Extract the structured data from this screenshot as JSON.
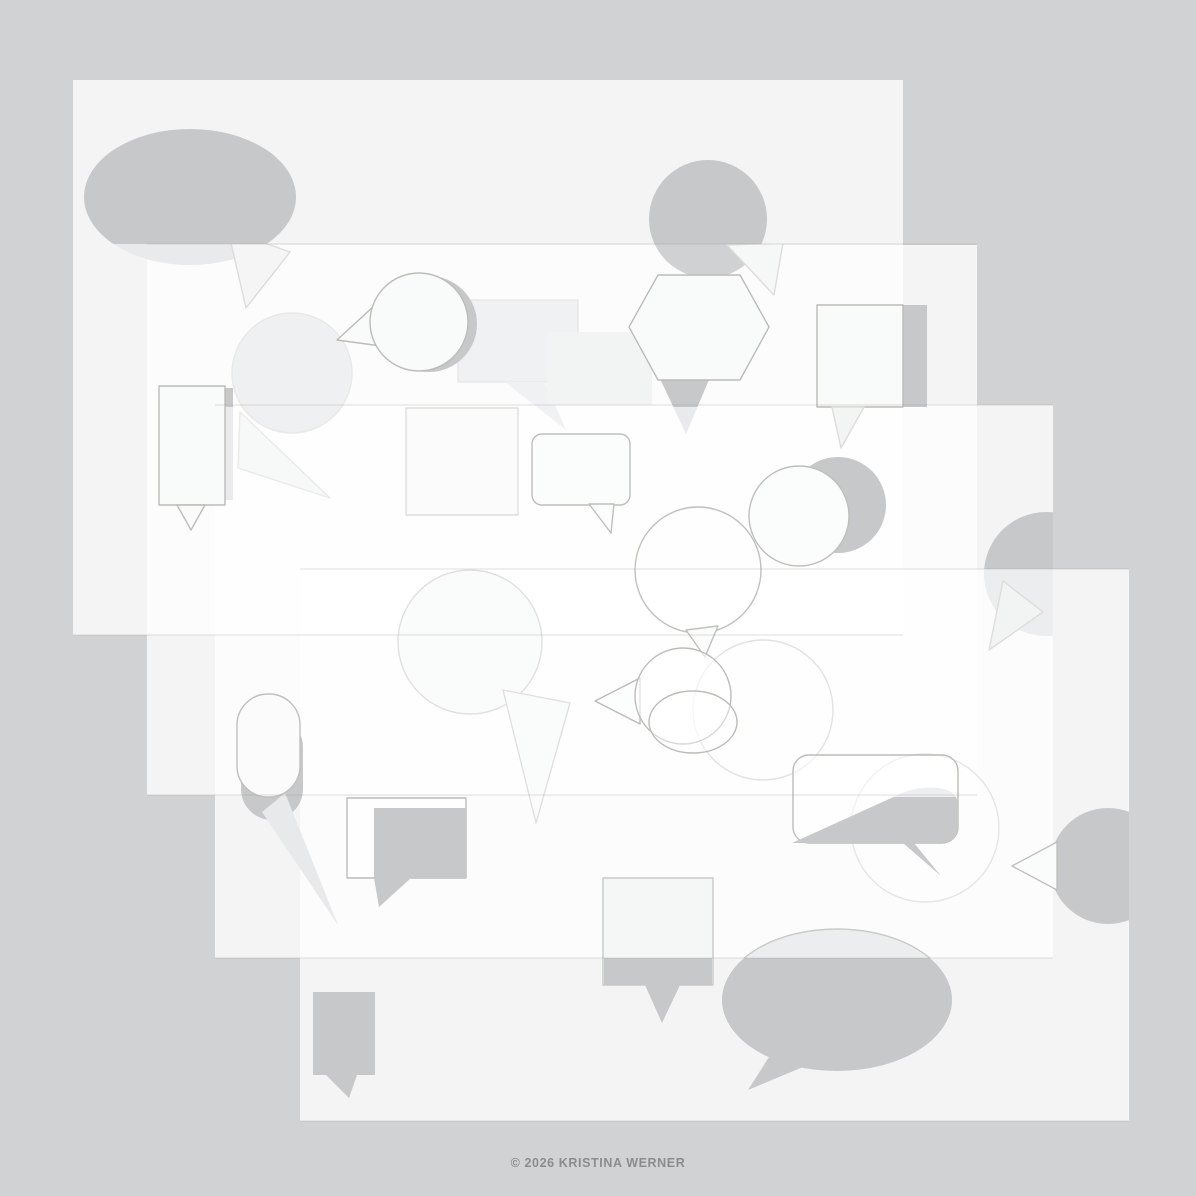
{
  "canvas": {
    "width": 1196,
    "height": 1196,
    "background": "#D1D2D4"
  },
  "footer": {
    "copyright": "© 2026 KRISTINA WERNER",
    "color": "#8A8C8E"
  },
  "palette": {
    "sheet_fill": "rgba(255,255,255,0.75)",
    "shape_solid": "#C6C8CA",
    "shape_faded": "#E9EAEB",
    "outline": "#BCBCB7",
    "seam": "rgba(150,150,142,0.30)"
  },
  "sheets": [
    {
      "name": "sheet-1",
      "x": 73,
      "y": 80,
      "w": 830,
      "h": 555
    },
    {
      "name": "sheet-2",
      "x": 147,
      "y": 245,
      "w": 830,
      "h": 550
    },
    {
      "name": "sheet-3",
      "x": 215,
      "y": 405,
      "w": 838,
      "h": 553
    },
    {
      "name": "sheet-4",
      "x": 300,
      "y": 569,
      "w": 829,
      "h": 552
    }
  ],
  "clips": {
    "s1a244": [
      73,
      80,
      830,
      164
    ],
    "s1b244": [
      73,
      244,
      830,
      391
    ],
    "a244": [
      0,
      0,
      1196,
      244
    ],
    "b244": [
      0,
      244,
      1196,
      952
    ],
    "a407": [
      0,
      0,
      1196,
      407
    ],
    "b407": [
      0,
      407,
      1196,
      789
    ],
    "s3a569": [
      215,
      405,
      838,
      164
    ],
    "s3b569": [
      215,
      569,
      838,
      389
    ],
    "a797": [
      0,
      0,
      1196,
      797
    ],
    "b797": [
      0,
      797,
      1196,
      399
    ],
    "s4": [
      300,
      569,
      829,
      552
    ],
    "a958": [
      0,
      0,
      1196,
      958
    ],
    "b958": [
      0,
      958,
      1196,
      238
    ]
  },
  "seams": [
    {
      "x1": 147,
      "y": 244,
      "x2": 977
    },
    {
      "x1": 215,
      "y": 405,
      "x2": 1053
    },
    {
      "x1": 300,
      "y": 569,
      "x2": 1129
    },
    {
      "x1": 73,
      "y": 635,
      "x2": 903
    },
    {
      "x1": 147,
      "y": 795,
      "x2": 977
    },
    {
      "x1": 215,
      "y": 958,
      "x2": 1053
    },
    {
      "x1": 300,
      "y": 1121,
      "x2": 1129
    }
  ],
  "shapes": [
    {
      "name": "speech-bubble-ellipse-solid",
      "kind": "ellipse",
      "cx": 190,
      "cy": 197,
      "rx": 106,
      "ry": 68,
      "fill": "#C6C8CA",
      "clip": "s1a244"
    },
    {
      "name": "speech-bubble-ellipse-solid-faded",
      "kind": "ellipse",
      "cx": 190,
      "cy": 197,
      "rx": 106,
      "ry": 68,
      "fill": "#E9EAEB",
      "clip": "s1b244"
    },
    {
      "name": "speech-bubble-ellipse-tail-outline",
      "kind": "polygon",
      "points": [
        [
          228,
          230
        ],
        [
          290,
          252
        ],
        [
          246,
          308
        ]
      ],
      "fill": "#F5F5F6",
      "stroke": "#DCDCD8",
      "clip": "b244"
    },
    {
      "name": "speech-bubble-circle-solid",
      "kind": "circle",
      "cx": 708,
      "cy": 219,
      "r": 59,
      "fill": "#C6C8CA",
      "clip": "a244"
    },
    {
      "name": "speech-bubble-circle-solid-faded",
      "kind": "circle",
      "cx": 708,
      "cy": 219,
      "r": 59,
      "fill": "#CFD1D3",
      "clip": "b244"
    },
    {
      "name": "speech-bubble-circle-tail-outline",
      "kind": "polygon",
      "points": [
        [
          727,
          245
        ],
        [
          783,
          243
        ],
        [
          774,
          295
        ]
      ],
      "fill": "#F6F7F7",
      "stroke": "#DDDDD9",
      "clip": "b244"
    },
    {
      "name": "speech-bubble-round-faint",
      "kind": "circle",
      "cx": 292,
      "cy": 373,
      "r": 60,
      "fill": "#EFF0F1",
      "stroke": "#E8E8E5"
    },
    {
      "name": "speech-bubble-round-faint-tail",
      "kind": "polygon",
      "points": [
        [
          240,
          412
        ],
        [
          330,
          498
        ],
        [
          238,
          468
        ]
      ],
      "fill": "#F7F8F8",
      "stroke": "#EAEAE7"
    },
    {
      "name": "speech-bubble-rect-faint",
      "kind": "rect",
      "x": 458,
      "y": 300,
      "w": 120,
      "h": 82,
      "fill": "#F0F1F2",
      "stroke": "#E8E8E5"
    },
    {
      "name": "speech-bubble-rect-faint-tail",
      "kind": "polygon",
      "points": [
        [
          505,
          382
        ],
        [
          545,
          382
        ],
        [
          566,
          430
        ]
      ],
      "fill": "#F0F1F2"
    },
    {
      "name": "speech-bubble-square-faint",
      "kind": "rect",
      "x": 547,
      "y": 332,
      "w": 105,
      "h": 73,
      "fill": "#F2F3F3"
    },
    {
      "name": "speech-bubble-drop-solid-offset",
      "kind": "circle",
      "cx": 429,
      "cy": 324,
      "r": 48,
      "fill": "#C6C8CA"
    },
    {
      "name": "speech-bubble-drop-tail-outline",
      "kind": "polygon",
      "points": [
        [
          337,
          340
        ],
        [
          399,
          283
        ],
        [
          381,
          346
        ]
      ],
      "fill": "#F9FAFA",
      "stroke": "#BCBCB7"
    },
    {
      "name": "speech-bubble-drop-outline",
      "kind": "circle",
      "cx": 419,
      "cy": 322,
      "r": 49,
      "fill": "#F9FAFA",
      "stroke": "#BCBCB7"
    },
    {
      "name": "speech-bubble-tag-solid-offset",
      "kind": "rect",
      "x": 174,
      "y": 388,
      "w": 59,
      "h": 112,
      "fill": "#C6C8CA",
      "clip": "a407"
    },
    {
      "name": "speech-bubble-tag-solid-faded",
      "kind": "rect",
      "x": 174,
      "y": 388,
      "w": 59,
      "h": 112,
      "fill": "#E9EAEB",
      "clip": "b407"
    },
    {
      "name": "speech-bubble-tag-outline",
      "kind": "rect",
      "x": 159,
      "y": 386,
      "w": 66,
      "h": 119,
      "fill": "#F9FAFA",
      "stroke": "#BCBCB7"
    },
    {
      "name": "speech-bubble-tag-tail-outline",
      "kind": "polygon",
      "points": [
        [
          177,
          505
        ],
        [
          205,
          505
        ],
        [
          191,
          530
        ]
      ],
      "fill": "#F9FAFA",
      "stroke": "#BCBCB7"
    },
    {
      "name": "speech-bubble-hexagon-tail-solid",
      "kind": "polygon",
      "points": [
        [
          655,
          368
        ],
        [
          714,
          368
        ],
        [
          686,
          434
        ]
      ],
      "fill": "#C6C8CA",
      "clip": "a407"
    },
    {
      "name": "speech-bubble-hexagon-tail-faded",
      "kind": "polygon",
      "points": [
        [
          655,
          368
        ],
        [
          714,
          368
        ],
        [
          686,
          434
        ]
      ],
      "fill": "#E9EAEB",
      "clip": "b407"
    },
    {
      "name": "speech-bubble-hexagon-outline",
      "kind": "polygon",
      "points": [
        [
          658,
          275
        ],
        [
          740,
          275
        ],
        [
          769,
          327
        ],
        [
          740,
          380
        ],
        [
          658,
          380
        ],
        [
          629,
          327
        ]
      ],
      "fill": "#F9FAFA",
      "stroke": "#BCBCB7"
    },
    {
      "name": "speech-bubble-square2-solid-offset",
      "kind": "rect",
      "x": 841,
      "y": 305,
      "w": 86,
      "h": 102,
      "fill": "#C6C8CA"
    },
    {
      "name": "speech-bubble-square2-outline",
      "kind": "rect",
      "x": 817,
      "y": 305,
      "w": 86,
      "h": 102,
      "fill": "#F9FAFA",
      "stroke": "#BCBCB7"
    },
    {
      "name": "speech-bubble-square2-tail-faded",
      "kind": "polygon",
      "points": [
        [
          832,
          407
        ],
        [
          864,
          407
        ],
        [
          841,
          448
        ]
      ],
      "fill": "#F3F4F4",
      "stroke": "#DCDCD8"
    },
    {
      "name": "speech-bubble-square3-faint-outline",
      "kind": "rect",
      "x": 406,
      "y": 408,
      "w": 112,
      "h": 107,
      "fill": "#FBFBFC",
      "stroke": "#DEDEDA"
    },
    {
      "name": "speech-bubble-round2-faint-outline",
      "kind": "circle",
      "cx": 470,
      "cy": 642,
      "r": 72,
      "fill": "#FAFBFB",
      "stroke": "#E0E0DC"
    },
    {
      "name": "speech-bubble-round2-faint-tail",
      "kind": "polygon",
      "points": [
        [
          503,
          690
        ],
        [
          570,
          703
        ],
        [
          536,
          823
        ]
      ],
      "fill": "#FAFBFB",
      "stroke": "#E0E0DC"
    },
    {
      "name": "speech-bubble-chatround-outline",
      "kind": "rect",
      "x": 532,
      "y": 434,
      "w": 98,
      "h": 71,
      "rad": 10,
      "fill": "#FBFCFC",
      "stroke": "#BFBFBA"
    },
    {
      "name": "speech-bubble-chatround-tail",
      "kind": "polygon",
      "points": [
        [
          589,
          504
        ],
        [
          614,
          504
        ],
        [
          611,
          533
        ]
      ],
      "fill": "#FBFCFC",
      "stroke": "#BFBFBA"
    },
    {
      "name": "speech-bubble-balloon-outline",
      "kind": "circle",
      "cx": 698,
      "cy": 570,
      "r": 63,
      "fill": "rgba(255,255,255,0.45)",
      "stroke": "#C1C1BC"
    },
    {
      "name": "speech-bubble-balloon-tail",
      "kind": "polygon",
      "points": [
        [
          686,
          630
        ],
        [
          718,
          626
        ],
        [
          705,
          657
        ]
      ],
      "fill": "#FBFCFC",
      "stroke": "#C1C1BC"
    },
    {
      "name": "speech-bubble-round3-solid-offset",
      "kind": "circle",
      "cx": 838,
      "cy": 505,
      "r": 48,
      "fill": "#C6C8CA"
    },
    {
      "name": "speech-bubble-round3-outline",
      "kind": "circle",
      "cx": 799,
      "cy": 516,
      "r": 50,
      "fill": "#FBFCFC",
      "stroke": "#BFBFBA"
    },
    {
      "name": "speech-bubble-disc-solid",
      "kind": "circle",
      "cx": 1046,
      "cy": 574,
      "r": 62,
      "fill": "#C6C8CA",
      "clip": "s3a569"
    },
    {
      "name": "speech-bubble-disc-solid-faded",
      "kind": "circle",
      "cx": 1046,
      "cy": 574,
      "r": 62,
      "fill": "#ECEDEE",
      "clip": "s3b569"
    },
    {
      "name": "speech-bubble-disc-tail-faded",
      "kind": "polygon",
      "points": [
        [
          1003,
          581
        ],
        [
          1043,
          612
        ],
        [
          989,
          650
        ]
      ],
      "fill": "#F2F3F3",
      "stroke": "#DDDDD9"
    },
    {
      "name": "speech-bubble-stadium-solid-offset",
      "kind": "rect",
      "x": 241,
      "y": 716,
      "w": 62,
      "h": 104,
      "rad": 31,
      "fill": "#C6C8CA"
    },
    {
      "name": "speech-bubble-stadium-tail-faded",
      "kind": "polygon",
      "points": [
        [
          285,
          793
        ],
        [
          338,
          925
        ],
        [
          262,
          812
        ]
      ],
      "fill": "#E8E9EA"
    },
    {
      "name": "speech-bubble-stadium-outline",
      "kind": "rect",
      "x": 237,
      "y": 694,
      "w": 63,
      "h": 103,
      "rad": 31,
      "fill": "#FBFBFC",
      "stroke": "#C0C0BB"
    },
    {
      "name": "speech-bubble-round4-faint",
      "kind": "circle",
      "cx": 763,
      "cy": 710,
      "r": 70,
      "fill": "rgba(255,255,255,0.3)",
      "stroke": "#E2E2DF"
    },
    {
      "name": "speech-bubble-round5-faint",
      "kind": "circle",
      "cx": 925,
      "cy": 828,
      "r": 74,
      "fill": "rgba(255,255,255,0.25)",
      "stroke": "#E5E5E2"
    },
    {
      "name": "speech-bubble-pop-tail-outline",
      "kind": "polygon",
      "points": [
        [
          595,
          701
        ],
        [
          640,
          678
        ],
        [
          640,
          724
        ]
      ],
      "fill": "#FCFDFD",
      "stroke": "#BCBCB7"
    },
    {
      "name": "speech-bubble-pop-outline",
      "kind": "circle",
      "cx": 683,
      "cy": 696,
      "r": 48,
      "fill": "rgba(255,255,255,0.55)",
      "stroke": "#BCBCB7"
    },
    {
      "name": "speech-bubble-pop2-outline",
      "kind": "ellipse",
      "cx": 693,
      "cy": 722,
      "rx": 44,
      "ry": 31,
      "fill": "rgba(255,255,255,0.4)",
      "stroke": "#BCBCB7"
    },
    {
      "name": "speech-bubble-message-outline",
      "kind": "rect",
      "x": 793,
      "y": 755,
      "w": 165,
      "h": 88,
      "rad": 16,
      "fill": "rgba(255,255,255,0.5)",
      "stroke": "#BCBCB7"
    },
    {
      "name": "speech-bubble-message-solid-faded",
      "kind": "path",
      "d": "M 792 843 L 898 795 Q 916 786 938 788 Q 958 790 958 806 L 958 826 Q 958 843 938 843 L 914 843 L 941 876 L 903 843 Z",
      "fill": "#EDEEEF",
      "clip": "a797"
    },
    {
      "name": "speech-bubble-message-solid",
      "kind": "path",
      "d": "M 792 843 L 898 795 Q 916 786 938 788 Q 958 790 958 806 L 958 826 Q 958 843 938 843 L 914 843 L 941 876 L 903 843 Z",
      "fill": "#C6C8CA",
      "clip": "b797"
    },
    {
      "name": "speech-bubble-disc2-solid",
      "kind": "circle",
      "cx": 1108,
      "cy": 866,
      "r": 58,
      "fill": "#C6C8CA",
      "clip": "s4"
    },
    {
      "name": "speech-bubble-disc2-tail-outline",
      "kind": "polygon",
      "points": [
        [
          1012,
          866
        ],
        [
          1057,
          842
        ],
        [
          1057,
          890
        ]
      ],
      "fill": "#FAFBFB",
      "stroke": "#C0C0BB"
    },
    {
      "name": "speech-bubble-chat2-outline",
      "kind": "rect",
      "x": 347,
      "y": 798,
      "w": 119,
      "h": 80,
      "fill": "rgba(255,255,255,0.6)",
      "stroke": "#BCBCB7"
    },
    {
      "name": "speech-bubble-chat2-solid-offset",
      "kind": "rect",
      "x": 374,
      "y": 808,
      "w": 92,
      "h": 70,
      "fill": "#C6C8CA"
    },
    {
      "name": "speech-bubble-chat2-tail",
      "kind": "polygon",
      "points": [
        [
          374,
          878
        ],
        [
          411,
          878
        ],
        [
          379,
          907
        ]
      ],
      "fill": "#C6C8CA"
    },
    {
      "name": "speech-bubble-banner-solid",
      "kind": "rect",
      "x": 313,
      "y": 992,
      "w": 62,
      "h": 83,
      "fill": "#C6C8CA"
    },
    {
      "name": "speech-bubble-banner-tail",
      "kind": "polygon",
      "points": [
        [
          326,
          1075
        ],
        [
          357,
          1075
        ],
        [
          349,
          1098
        ]
      ],
      "fill": "#C6C8CA"
    },
    {
      "name": "speech-bubble-square4-outline",
      "kind": "rect",
      "x": 603,
      "y": 878,
      "w": 110,
      "h": 107,
      "fill": "#F5F6F6",
      "stroke": "#C9C9C5"
    },
    {
      "name": "speech-bubble-square4-solid-band",
      "kind": "rect",
      "x": 604,
      "y": 958,
      "w": 108,
      "h": 27,
      "fill": "#C6C8CA"
    },
    {
      "name": "speech-bubble-square4-tail",
      "kind": "polygon",
      "points": [
        [
          645,
          985
        ],
        [
          680,
          985
        ],
        [
          662,
          1023
        ]
      ],
      "fill": "#C6C8CA"
    },
    {
      "name": "speech-bubble-ellipse2-solid-faded",
      "kind": "ellipse",
      "cx": 837,
      "cy": 1000,
      "rx": 115,
      "ry": 71,
      "fill": "#ECEDEE",
      "stroke": "#C9C9C5",
      "clip": "a958"
    },
    {
      "name": "speech-bubble-ellipse2-solid",
      "kind": "ellipse",
      "cx": 837,
      "cy": 1000,
      "rx": 115,
      "ry": 71,
      "fill": "#C6C8CA",
      "clip": "b958"
    },
    {
      "name": "speech-bubble-ellipse2-tail",
      "kind": "polygon",
      "points": [
        [
          785,
          1032
        ],
        [
          815,
          1062
        ],
        [
          748,
          1090
        ]
      ],
      "fill": "#C6C8CA"
    }
  ]
}
